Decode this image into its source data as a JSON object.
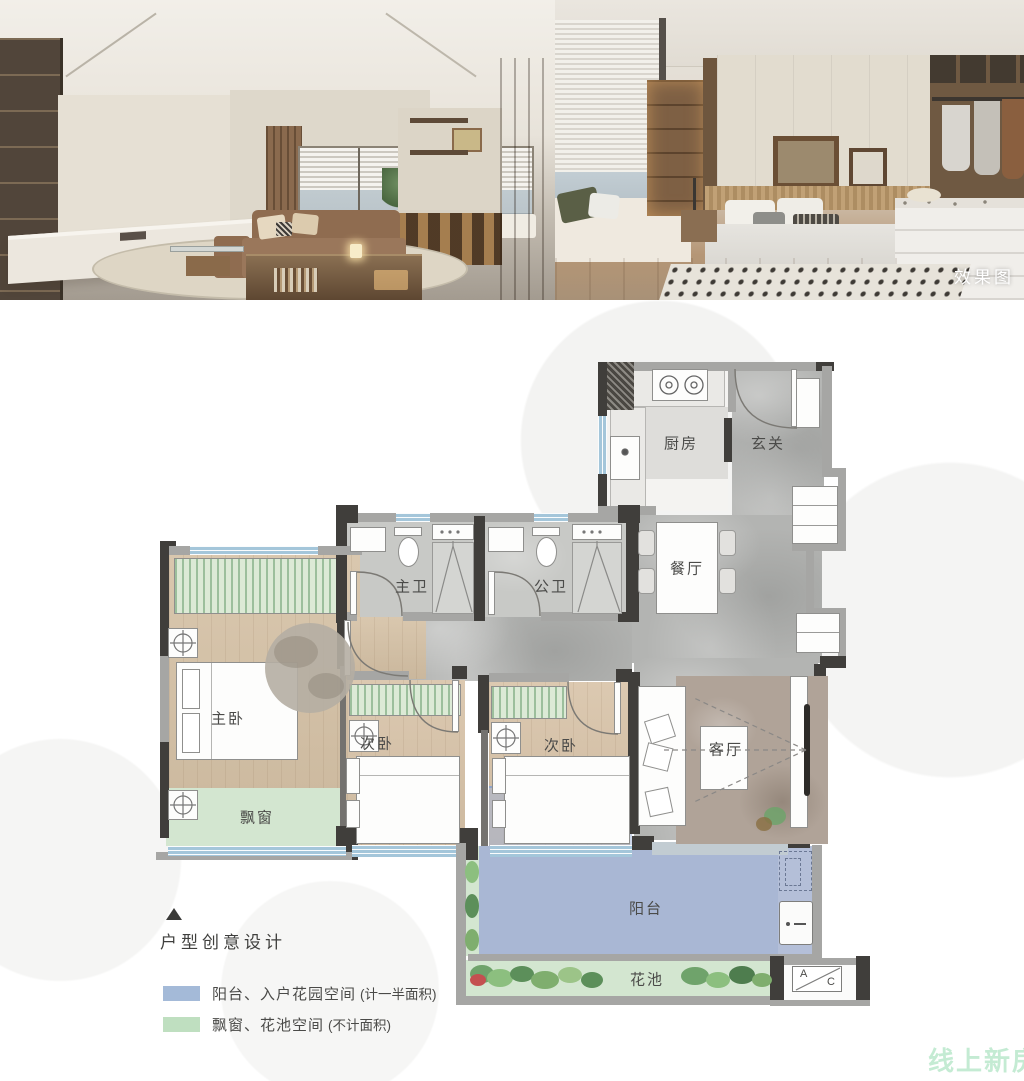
{
  "photos": {
    "tag": "效果图",
    "left_photo": "living-room-render",
    "right_photo": "bedroom-render"
  },
  "floorplan": {
    "rooms": {
      "kitchen": "厨房",
      "foyer": "玄关",
      "dining": "餐厅",
      "master_bath": "主卫",
      "public_bath": "公卫",
      "master_bedroom": "主卧",
      "bedroom_2": "次卧",
      "bedroom_3": "次卧",
      "living_room": "客厅",
      "bay_window": "飘窗",
      "balcony": "阳台",
      "flower_bed": "花池"
    },
    "ac_platform": {
      "a": "A",
      "c": "C"
    }
  },
  "legend": {
    "title": "户型创意设计",
    "items": [
      {
        "swatch": "#a4bad8",
        "label": "阳台、入户花园空间",
        "note": "(计一半面积)"
      },
      {
        "swatch": "#bfdfc0",
        "label": "飘窗、花池空间",
        "note": "(不计面积)"
      }
    ]
  },
  "watermark": "线上新房",
  "colors": {
    "wall_dark": "#403e3b",
    "wall_gray": "#a6a6a4",
    "marble_floor": "#b3b4b2",
    "wood_floor": "#d5c1a5",
    "window_strip": "#a4c6da",
    "balcony_fill": "#a9b7d4",
    "garden_fill": "#d3e6d0",
    "watermark_green": "#93dbaf"
  }
}
